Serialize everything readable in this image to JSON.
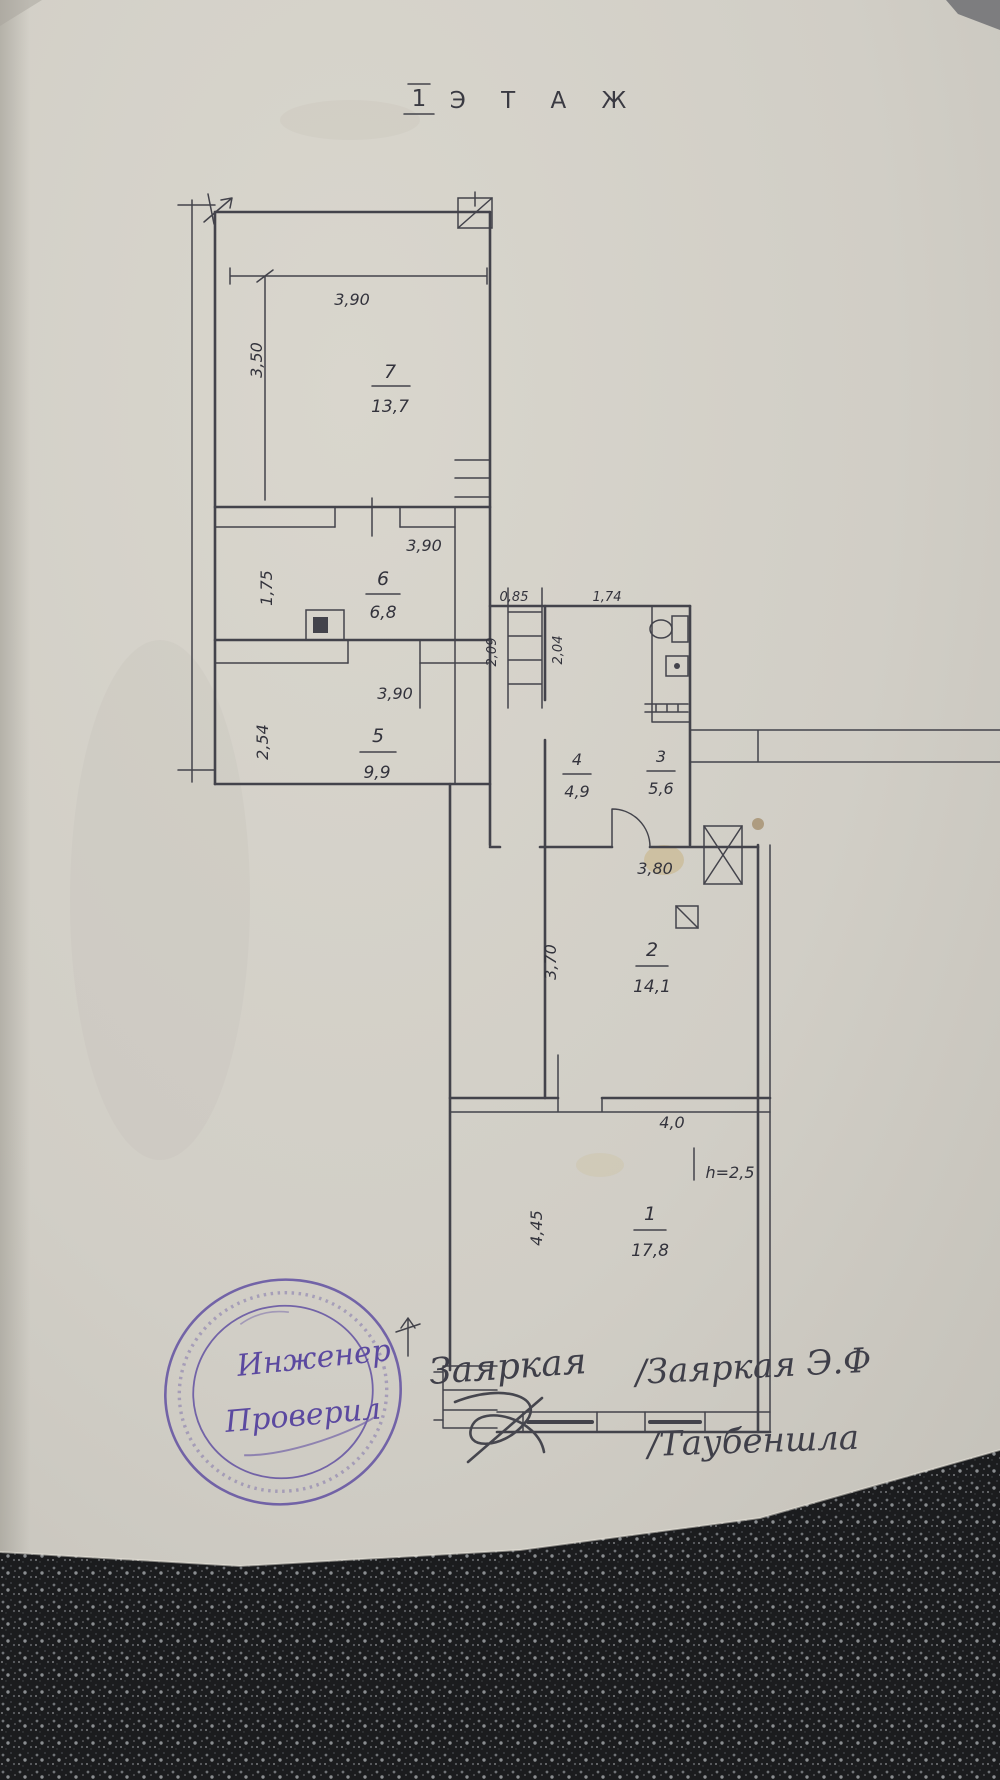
{
  "page": {
    "title_number": "1",
    "title_word": "Э Т А Ж"
  },
  "plan": {
    "rooms": [
      {
        "number": "7",
        "area": "13,7",
        "width_label": "3,90",
        "height_label": "3,50"
      },
      {
        "number": "6",
        "area": "6,8",
        "width_label": "3,90",
        "height_label": "1,75"
      },
      {
        "number": "5",
        "area": "9,9",
        "width_label": "3,90",
        "height_label": "2,54"
      },
      {
        "number": "4",
        "area": "4,9",
        "width_label": "0,85",
        "height_label": "2,09"
      },
      {
        "number": "3",
        "area": "5,6",
        "width_label": "1,74",
        "height_label": "2,04"
      },
      {
        "number": "2",
        "area": "14,1",
        "width_label": "3,80",
        "height_label": "3,70"
      },
      {
        "number": "1",
        "area": "17,8",
        "width_label": "4,0",
        "height_label": "4,45"
      }
    ],
    "note_height": "h=2,5"
  },
  "stamp": {
    "color": "#5b49a0",
    "word1": "Инженер",
    "word2": "Проверил"
  },
  "handwriting": {
    "center": "Заяркая",
    "right_line1": "/Заяркая Э.Ф",
    "right_line2": "/Таубеншла"
  }
}
